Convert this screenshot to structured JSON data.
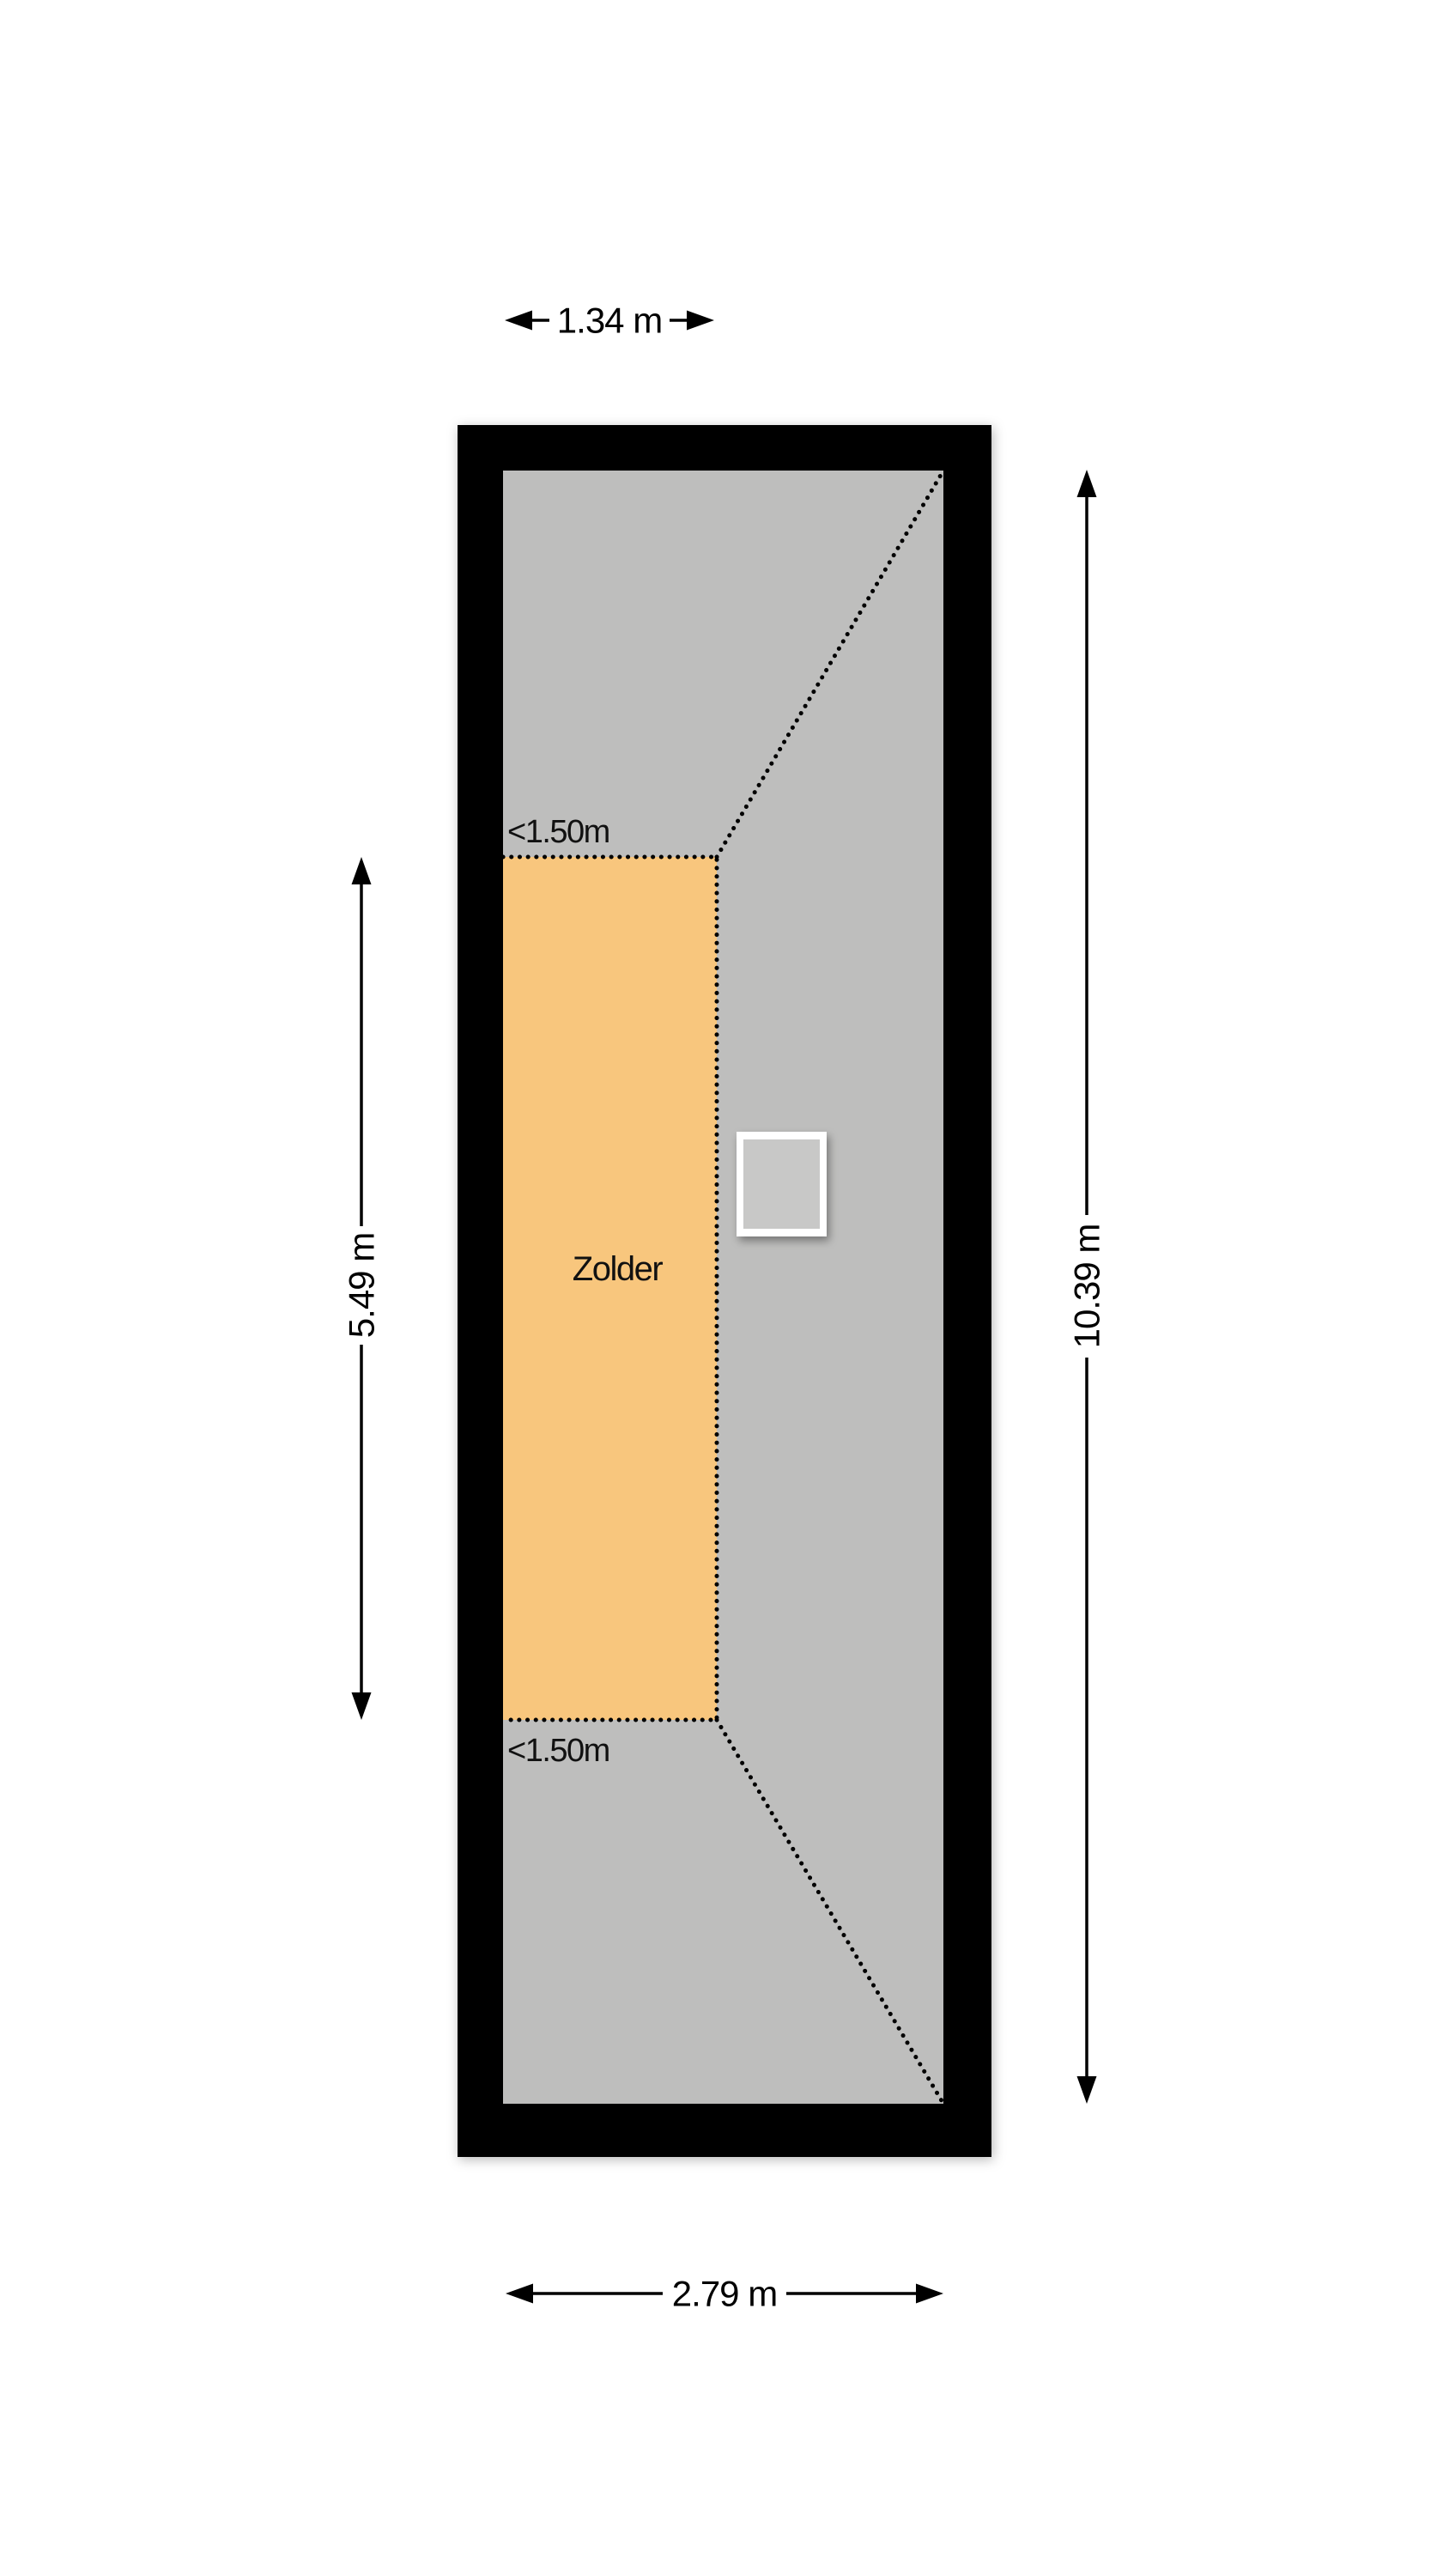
{
  "floorplan": {
    "room_label": "Zolder",
    "height_marker_top": "<1.50m",
    "height_marker_bottom": "<1.50m",
    "dim_top": "1.34 m",
    "dim_left": "5.49 m",
    "dim_right": "10.39 m",
    "dim_bottom": "2.79 m"
  },
  "colors": {
    "wall": "#000000",
    "floor": "#BEBEBD",
    "room": "#F8C67D",
    "skylight_frame": "#FFFFFF",
    "skylight_glass": "#C8C8C7",
    "line": "#000000"
  }
}
